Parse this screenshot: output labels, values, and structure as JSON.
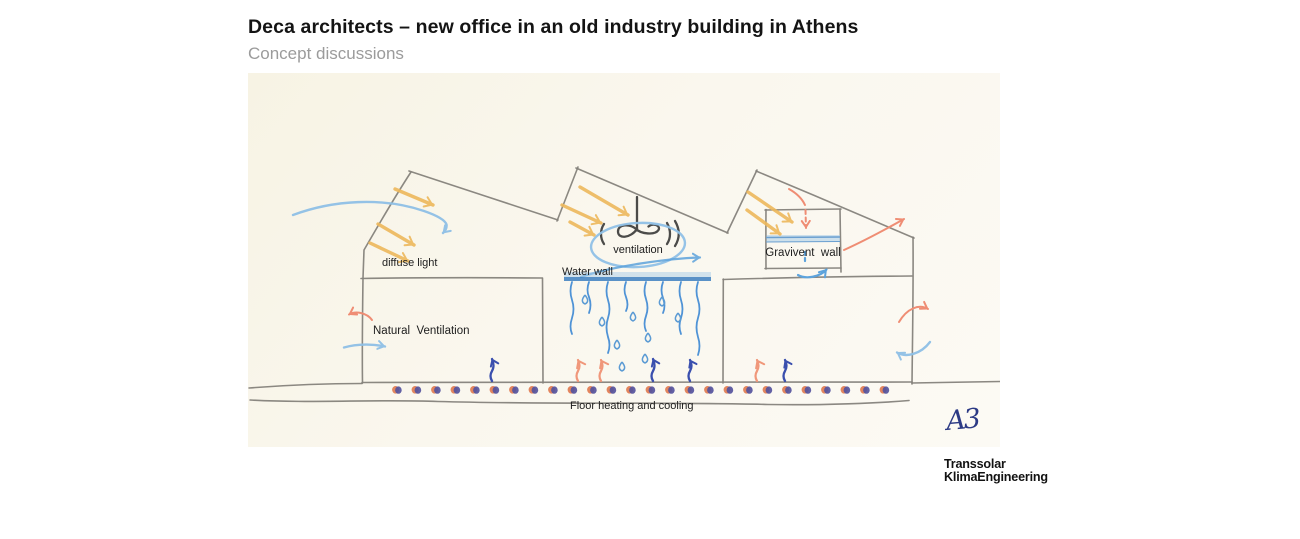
{
  "slide": {
    "title": "Deca architects – new office in an old industry building in Athens",
    "subtitle": "Concept discussions"
  },
  "sketch": {
    "labels": {
      "diffuse_light": "diffuse light",
      "ventilation": "ventilation",
      "water_wall": "Water wall",
      "gravivent_wall": "Gravivent  wall",
      "natural_ventilation": "Natural  Ventilation",
      "floor_heating_cooling": "Floor heating and cooling",
      "signature": "A3"
    },
    "colors": {
      "paper": "#faf7ee",
      "pencil": "#85827b",
      "sun_yellow": "#edb85c",
      "sky_blue": "#8fc0e6",
      "water_blue": "#4f93d6",
      "warm_red": "#ef8d74",
      "warm_orange": "#f0977a",
      "ink_navy": "#3a4fae",
      "signature_navy": "#2c3a85"
    }
  },
  "footer": {
    "logo_line1": "Transsolar",
    "logo_line2": "KlimaEngineering"
  }
}
